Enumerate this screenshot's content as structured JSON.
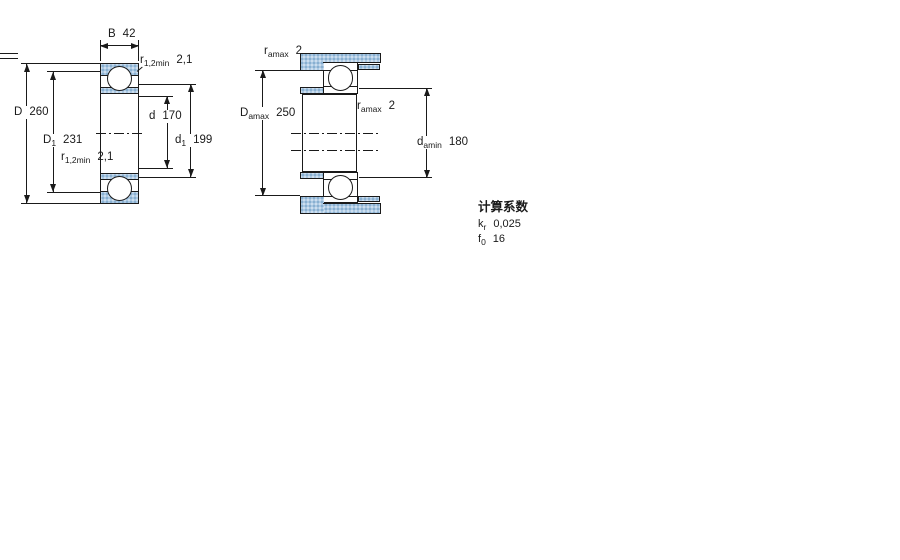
{
  "figure_left": {
    "labels": {
      "width": {
        "main": "B",
        "sub": "",
        "value": "42"
      },
      "outer_diameter": {
        "main": "D",
        "sub": "",
        "value": "260"
      },
      "outer_shoulder": {
        "main": "D",
        "sub": "1",
        "value": "231"
      },
      "bore": {
        "main": "d",
        "sub": "",
        "value": "170"
      },
      "inner_shoulder": {
        "main": "d",
        "sub": "1",
        "value": "199"
      },
      "fillet_top": {
        "main": "r",
        "sub": "1,2min",
        "value": "2,1"
      },
      "fillet_mid": {
        "main": "r",
        "sub": "1,2min",
        "value": "2,1"
      }
    }
  },
  "figure_right": {
    "labels": {
      "fillet_top": {
        "main": "r",
        "sub": "amax",
        "value": "2"
      },
      "fillet_mid": {
        "main": "r",
        "sub": "amax",
        "value": "2"
      },
      "housing_shoulder": {
        "main": "D",
        "sub": "amax",
        "value": "250"
      },
      "shaft_shoulder": {
        "main": "d",
        "sub": "amin",
        "value": "180"
      }
    }
  },
  "calculation_factors": {
    "title": "计算系数",
    "rows": [
      {
        "main": "k",
        "sub": "r",
        "value": "0,025"
      },
      {
        "main": "f",
        "sub": "0",
        "value": "16"
      }
    ]
  },
  "colors": {
    "hatch_fill": "#ABC8E2",
    "hatch_dot": "#7EA8CB",
    "line": "#1A1A1A",
    "background": "#FFFFFF"
  }
}
